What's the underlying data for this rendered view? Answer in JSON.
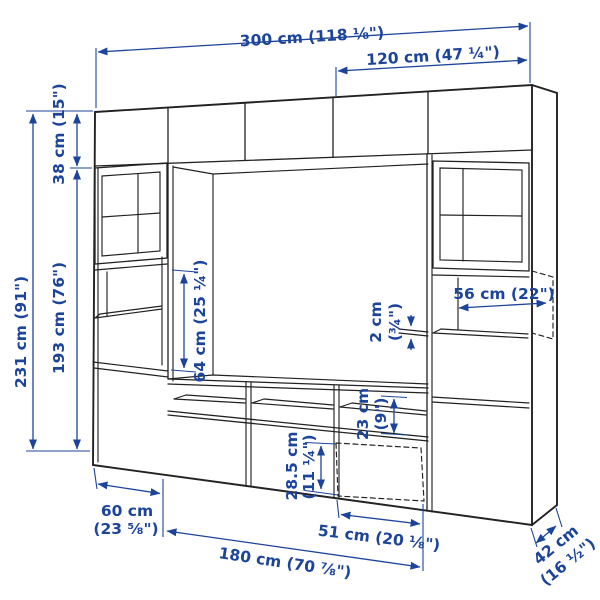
{
  "page": {
    "title": "TV storage combination dimension diagram",
    "background": "#ffffff"
  },
  "colors": {
    "dimension_blue": "#1c449b",
    "line_black": "#222222"
  },
  "diagram": {
    "subject": "wall storage combination with glass doors, open shelves, TV bench and drawers",
    "style": "line drawing with dimension arrows"
  },
  "dimensions": {
    "total_width": "300 cm (118 ⅛\")",
    "right_section_width": "120 cm (47 ¼\")",
    "total_height": "231 cm (91\")",
    "top_cabinet_height": "38 cm (15\")",
    "lower_section_height": "193 cm (76\")",
    "open_section_height": "64 cm (25 ¼\")",
    "shelf_width": "56 cm (22\")",
    "gap_value": "2 cm",
    "gap_inches": "(¾\")",
    "shelf_spacing_value": "23 cm",
    "shelf_spacing_inches": "(9\")",
    "drawer_height_value": "28.5 cm",
    "drawer_height_inches": "(11 ¼\")",
    "unit_width_value": "60 cm",
    "unit_width_inches": "(23 ⅝\")",
    "drawer_width": "51 cm (20 ⅛\")",
    "bench_width": "180 cm (70 ⅞\")",
    "depth": "42 cm (16 ½\")"
  }
}
